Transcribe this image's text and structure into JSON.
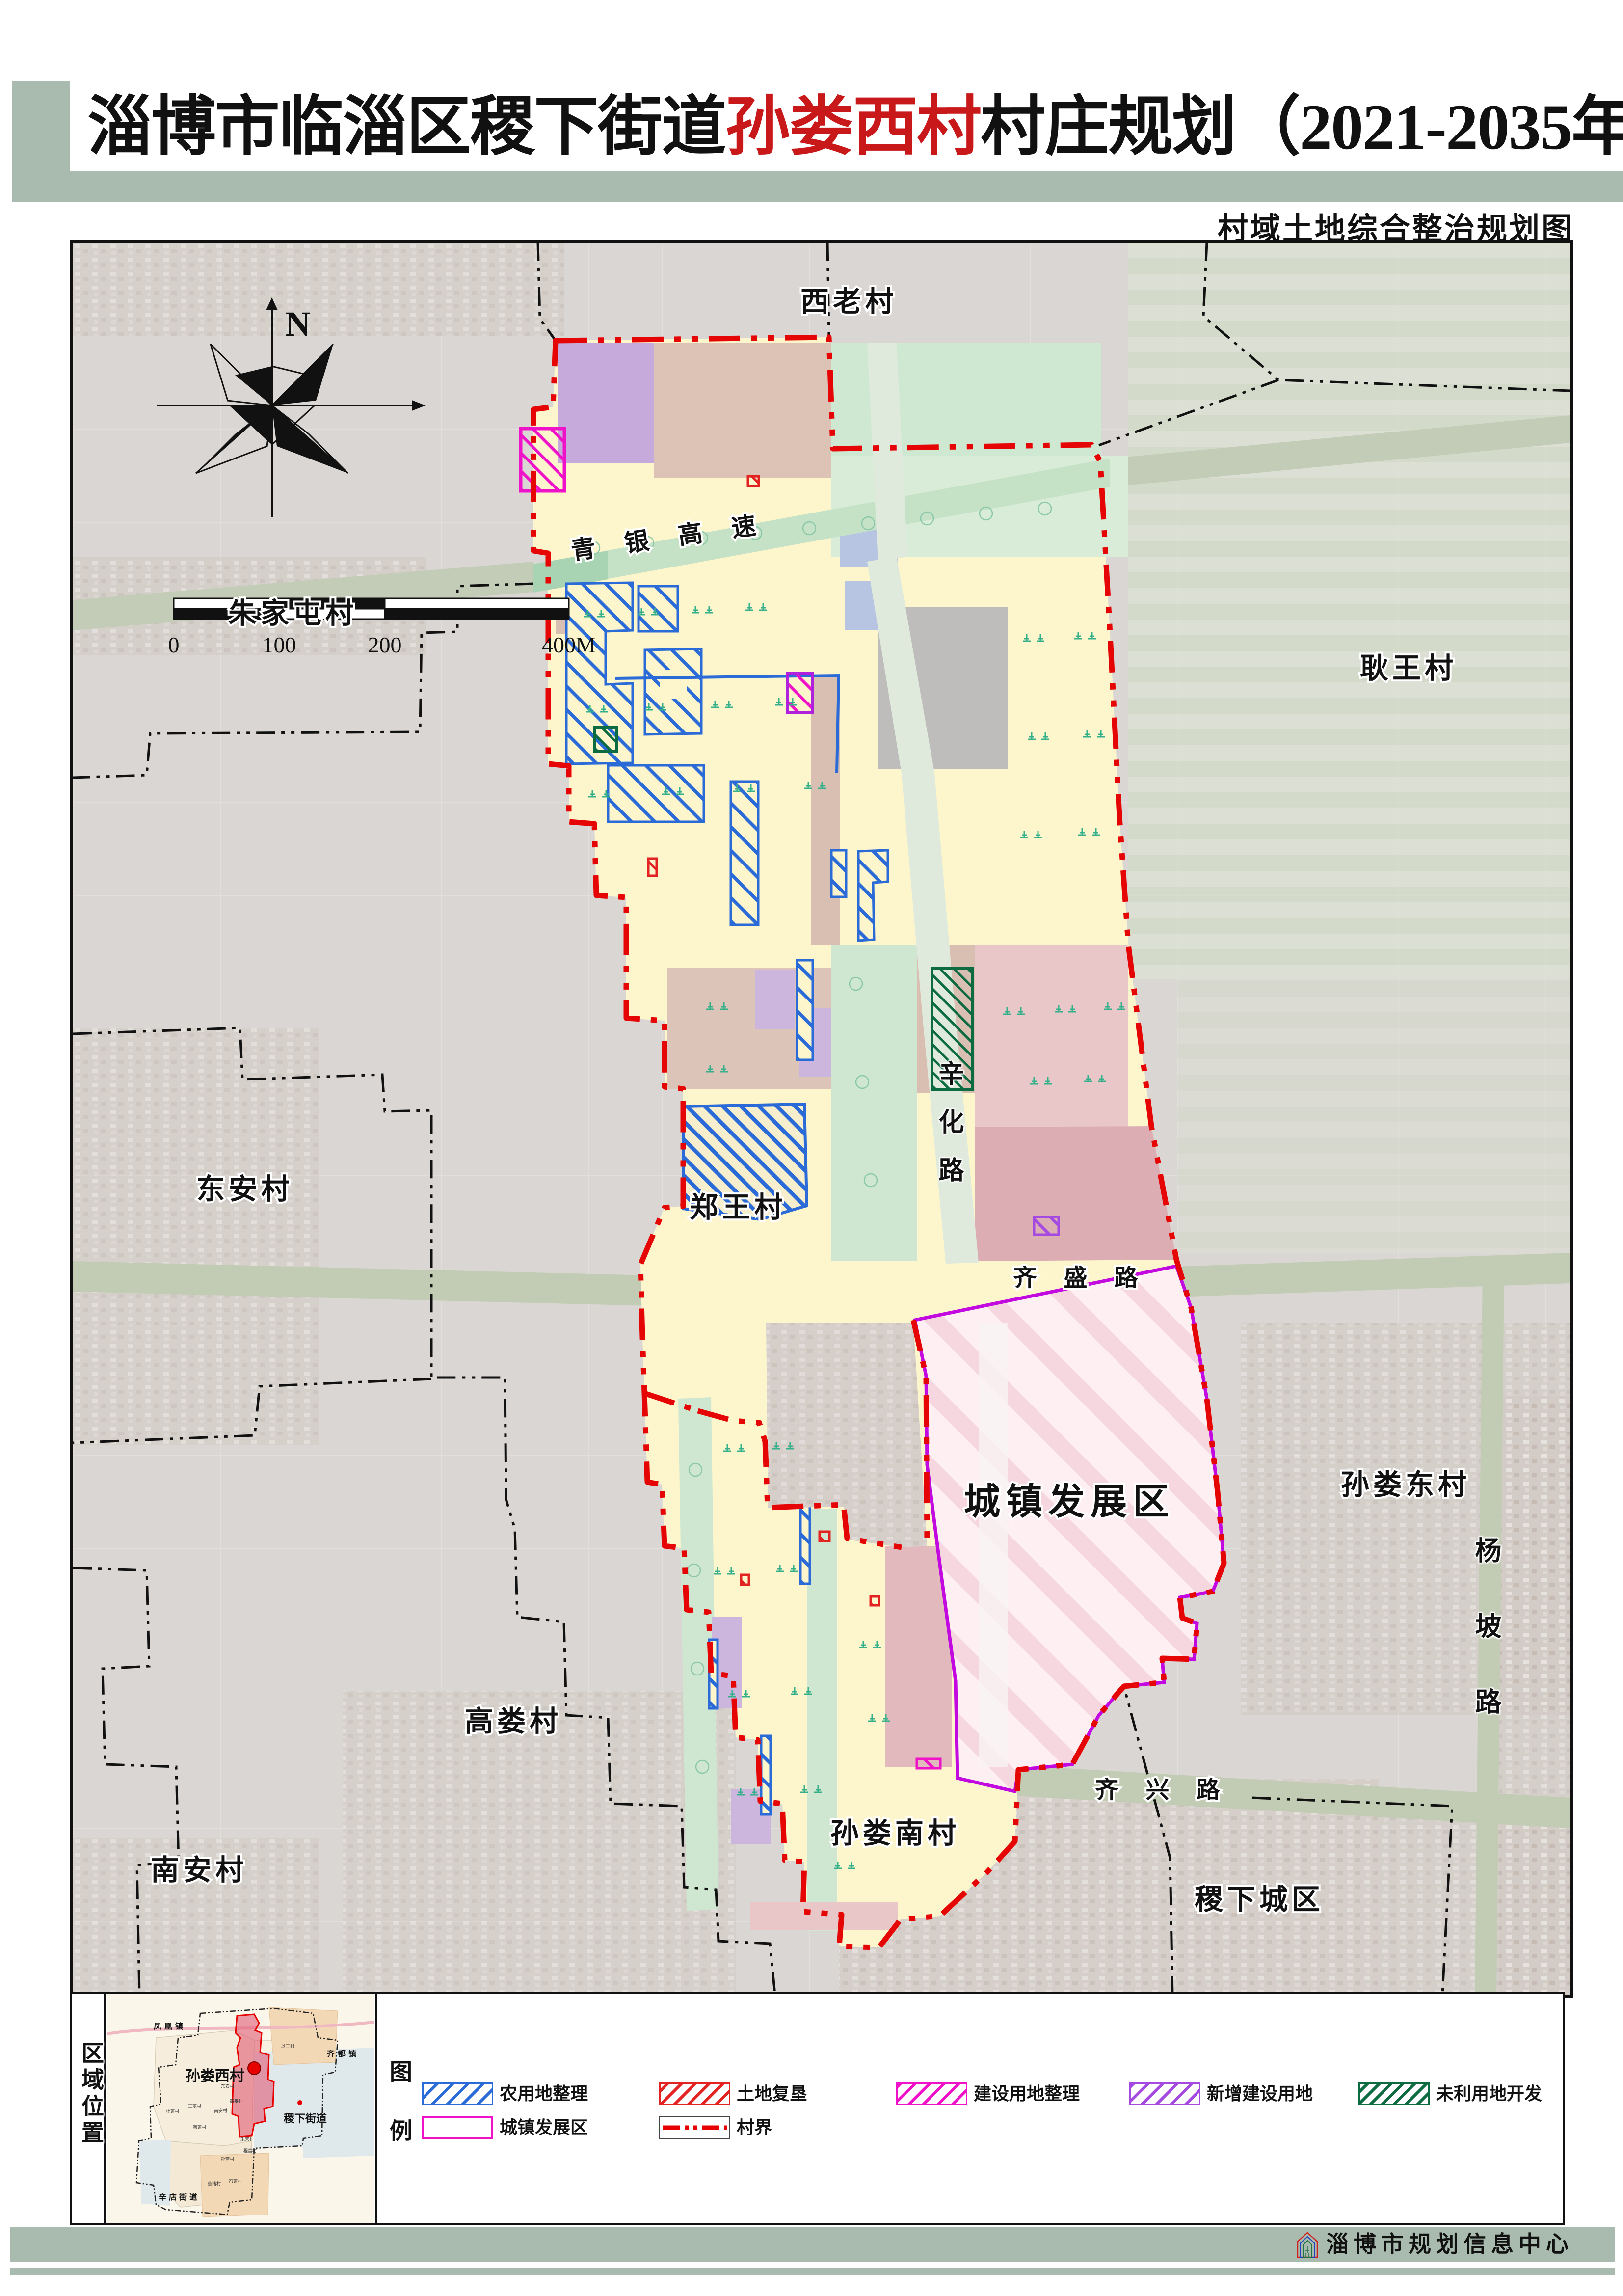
{
  "header": {
    "title_prefix": "淄博市临淄区稷下街道",
    "title_highlight": "孙娄西村",
    "title_suffix": "村庄规划（2021-2035年）",
    "subtitle": "村域土地综合整治规划图"
  },
  "compass": {
    "north_label": "N"
  },
  "scalebar": {
    "ticks": [
      "0",
      "100",
      "200",
      "400M"
    ]
  },
  "map_labels": {
    "villages": [
      {
        "text": "西老村"
      },
      {
        "text": "朱家屯村"
      },
      {
        "text": "耿王村"
      },
      {
        "text": "东安村"
      },
      {
        "text": "郑王村"
      },
      {
        "text": "孙娄东村"
      },
      {
        "text": "高娄村"
      },
      {
        "text": "南安村"
      },
      {
        "text": "孙娄南村"
      },
      {
        "text": "稷下城区"
      }
    ],
    "roads": [
      {
        "text": "青银高速"
      },
      {
        "text": "辛化路"
      },
      {
        "text": "齐盛路"
      },
      {
        "text": "齐兴路"
      },
      {
        "text": "杨坡路"
      }
    ],
    "zone": "城镇发展区"
  },
  "legend": {
    "row1": [
      {
        "label": "农用地整理",
        "color": "#2b6bd8"
      },
      {
        "label": "土地复垦",
        "color": "#e32222"
      },
      {
        "label": "建设用地整理",
        "color": "#ef12c9"
      },
      {
        "label": "新增建设用地",
        "color": "#a44ae0"
      },
      {
        "label": "未利用地开发",
        "color": "#0c6b40"
      }
    ],
    "row2": [
      {
        "label": "城镇发展区",
        "color": "#ef12c9"
      },
      {
        "label": "村界",
        "color": "#e60000"
      }
    ]
  },
  "panels": {
    "region_title": "区域位置",
    "legend_title": "图例"
  },
  "inset": {
    "big_labels": [
      {
        "text": "凤凰镇"
      },
      {
        "text": "齐都镇"
      },
      {
        "text": "孙娄西村"
      },
      {
        "text": "稷下街道"
      },
      {
        "text": "辛店街道"
      }
    ],
    "small_labels": [
      {
        "text": "耿王村"
      },
      {
        "text": "东安村"
      },
      {
        "text": "高娄村"
      },
      {
        "text": "王家村"
      },
      {
        "text": "杜家村"
      },
      {
        "text": "南安村"
      },
      {
        "text": "韩家村"
      },
      {
        "text": "朱营村"
      },
      {
        "text": "程营村"
      },
      {
        "text": "孙营村"
      },
      {
        "text": "董褚村"
      },
      {
        "text": "冯家村"
      }
    ]
  },
  "footer": {
    "credit": "淄博市规划信息中心"
  },
  "colors": {
    "boundary_red": "#e60000",
    "urban_border": "#c209e0",
    "sage": "#a9bbae"
  }
}
